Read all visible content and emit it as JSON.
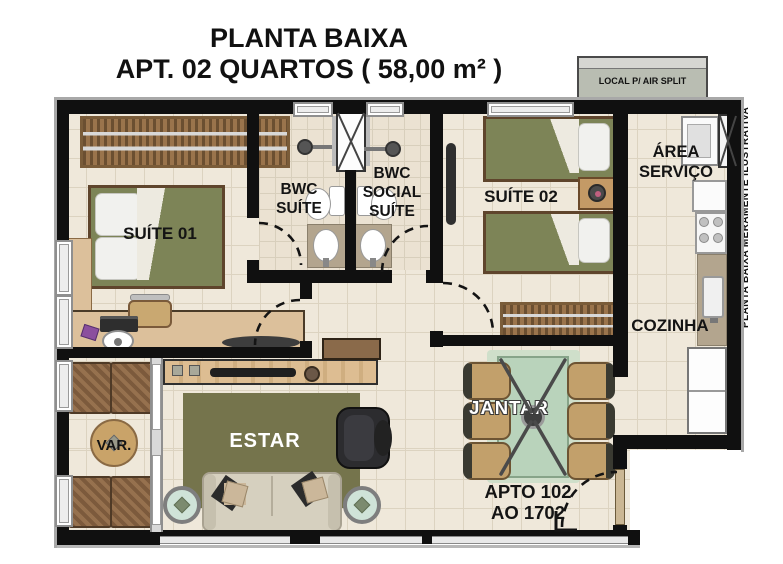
{
  "title": {
    "line1": "PLANTA BAIXA",
    "line2": "APT. 02 QUARTOS ( 58,00 m² )"
  },
  "side_note": "PLANTA BAIXA MERAMENTE ILUSTRATIVA",
  "air_split": {
    "label": "LOCAL P/ AIR SPLIT"
  },
  "rooms": {
    "suite01": {
      "label": "SUÍTE 01"
    },
    "bwc_suite": {
      "line1": "BWC",
      "line2": "SUÍTE"
    },
    "bwc_social": {
      "line1": "BWC",
      "line2": "SOCIAL",
      "line3": "SUÍTE"
    },
    "suite02": {
      "label": "SUÍTE 02"
    },
    "area_servico": {
      "line1": "ÁREA",
      "line2": "SERVIÇO"
    },
    "cozinha": {
      "label": "COZINHA"
    },
    "varanda": {
      "label": "VAR."
    },
    "estar": {
      "label": "ESTAR"
    },
    "jantar": {
      "label": "JANTAR"
    }
  },
  "entrance_note": {
    "line1": "APTO 102",
    "line2": "AO 1702"
  },
  "colors": {
    "wall": "#101010",
    "floor": "#efe8da",
    "floor_grid": "#dcd3c0",
    "bed_green": "#7d8457",
    "rug_olive": "#75744c",
    "wood_dark": "#8a6844",
    "wood_light": "#ddbd92",
    "dining_glass": "#b9d3bb",
    "granite": "#b3a58e"
  }
}
